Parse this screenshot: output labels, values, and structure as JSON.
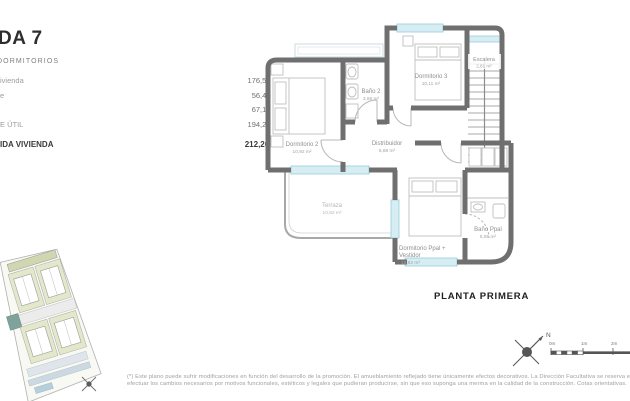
{
  "summary": {
    "title": "DA 7",
    "subtitle": "DORMITORIOS",
    "rows": [
      {
        "label": "ivienda",
        "value": "176,55 m2"
      },
      {
        "label": "e",
        "value": "56,43 m2"
      },
      {
        "label": "",
        "value": "67,15 m2"
      },
      {
        "label": "E ÚTIL",
        "value": "194,20 m2"
      },
      {
        "label": "IDA VIVIENDA",
        "value": "212,26 m2"
      }
    ]
  },
  "plan": {
    "floor_label": "PLANTA PRIMERA",
    "rooms": {
      "dormitorio2": {
        "name": "Dormitorio 2",
        "area": "10,92 m²"
      },
      "bano2": {
        "name": "Baño 2",
        "area": "3,68 m²"
      },
      "dormitorio3": {
        "name": "Dormitorio 3",
        "area": "10,11 m²"
      },
      "escalera": {
        "name": "Escalera",
        "area": "2,81 m²"
      },
      "distribuidor": {
        "name": "Distribuidor",
        "area": "6,88 m²"
      },
      "terraza": {
        "name": "Terraza",
        "area": "10,52 m²"
      },
      "dormitorio_ppal": {
        "line1": "Dormitorio Ppal +",
        "line2": "Vestidor",
        "area": "15,82 m²"
      },
      "bano_ppal": {
        "name": "Baño Ppal",
        "area": "5,55 m²"
      }
    }
  },
  "compass": {
    "north_label": "N"
  },
  "scalebar": {
    "labels": [
      "0m",
      "1m",
      "2m"
    ]
  },
  "disclaimer": {
    "line1": "(*) Este plano puede sufrir modificaciones en función del desarrollo de la promoción. El amueblamiento reflejado tiene únicamente efectos decorativos. La Dirección Facultativa se reserva el derecho a",
    "line2": "efectuar los cambios necesarios por motivos funcionales, estéticos y legales que pudieran producirse, sin que eso suponga una merma en la calidad de la construcción. Cotas orientativas."
  },
  "colors": {
    "wall_gray": "#6f6f6f",
    "window_cyan": "#d6edf3",
    "label_gray": "#8f8f8f",
    "site_green": "#e4e8cb",
    "site_teal": "#7fa39b"
  }
}
